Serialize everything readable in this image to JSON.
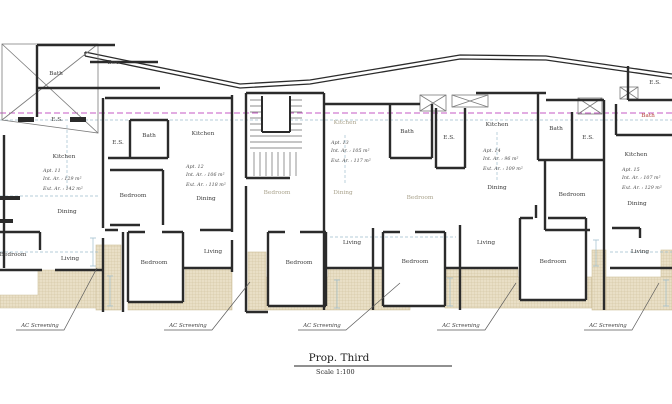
{
  "title_block": {
    "title": "Prop. Third",
    "scale": "Scale 1:100"
  },
  "labels": {
    "ac_screening": "AC Screening"
  },
  "apartments": [
    {
      "name": "Apt. 11",
      "int_area": "Int. Ar. : 129 m²",
      "ext_area": "Ext. Ar. : 142 m²"
    },
    {
      "name": "Apt. 12",
      "int_area": "Int. Ar. : 106 m²",
      "ext_area": "Ext. Ar. : 118 m²"
    },
    {
      "name": "Apt. 13",
      "int_area": "Int. Ar. : 105 m²",
      "ext_area": "Ext. Ar. : 117 m²"
    },
    {
      "name": "Apt. 14",
      "int_area": "Int. Ar. : 96 m²",
      "ext_area": "Ext. Ar. : 109 m²"
    },
    {
      "name": "Apt. 15",
      "int_area": "Int. Ar. : 107 m²",
      "ext_area": "Ext. Ar. : 129 m²"
    }
  ],
  "rooms": [
    {
      "label": "Bath"
    },
    {
      "label": "Box"
    },
    {
      "label": "E.S."
    },
    {
      "label": "Kitchen"
    },
    {
      "label": "Dining"
    },
    {
      "label": "Bedroom"
    },
    {
      "label": "Living"
    },
    {
      "label": "E.S."
    },
    {
      "label": "Bath"
    },
    {
      "label": "Kitchen"
    },
    {
      "label": "Bedroom"
    },
    {
      "label": "Dining"
    },
    {
      "label": "Bedroom"
    },
    {
      "label": "Living"
    },
    {
      "label": "Kitchen"
    },
    {
      "label": "Bedroom"
    },
    {
      "label": "Dining"
    },
    {
      "label": "Bath"
    },
    {
      "label": "Bedroom"
    },
    {
      "label": "Bedroom"
    },
    {
      "label": "Living"
    },
    {
      "label": "Bedroom"
    },
    {
      "label": "E.S."
    },
    {
      "label": "Kitchen"
    },
    {
      "label": "Dining"
    },
    {
      "label": "Bath"
    },
    {
      "label": "Bedroom"
    },
    {
      "label": "E.S."
    },
    {
      "label": "Living"
    },
    {
      "label": "Bedroom"
    },
    {
      "label": "E.S."
    },
    {
      "label": "Bath"
    },
    {
      "label": "Kitchen"
    },
    {
      "label": "Dining"
    },
    {
      "label": "Living"
    }
  ],
  "colors": {
    "wall": "#2b2b2b",
    "dim": "#9fbecd",
    "section": "#c45ac4",
    "hatch_fill": "#e9dfc6",
    "hatch_line": "#cdbf9a",
    "text": "#3a3a3a",
    "faded": "#a8a18a",
    "red": "#b5443c"
  }
}
